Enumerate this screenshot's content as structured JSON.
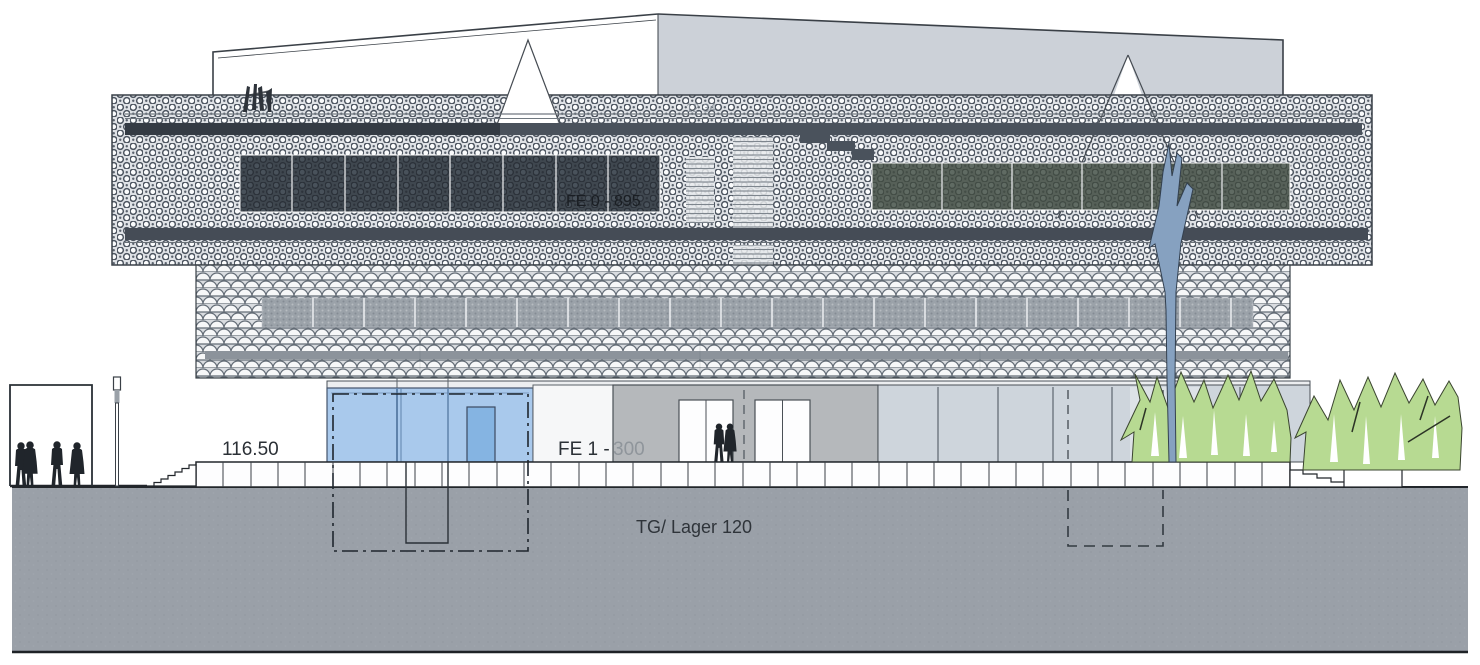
{
  "drawing_labels": {
    "plaza_level": "116.50",
    "facade_upper": "FE 0 - 895",
    "facade_ground_prefix": "FE 1 -",
    "facade_ground_suffix": "300",
    "basement": "TG/ Lager 120",
    "roof_faint_mark": "12 34"
  },
  "palette": {
    "facade_mesh_bg": "#dfe2e6",
    "facade_mesh_line": "#4e5661",
    "louver_strip_dark": "#3e454e",
    "window_band_dark": "#3f474f",
    "window_band_green": "#566058",
    "middle_window_gray": "#9ba2a9",
    "roof_gray": "#ccd1d8",
    "glass_blue": "#a9c9ec",
    "glass_door_blue": "#85b4e2",
    "entrance_wall_gray": "#b5b8bb",
    "glass_gray_right": "#ced5dc",
    "ground_mass_gray": "#9aa0a8",
    "tree_blue": "#86a1c0",
    "greenery": "#b7da92",
    "ink": "#22272d",
    "muted_text": "#8f959b"
  }
}
